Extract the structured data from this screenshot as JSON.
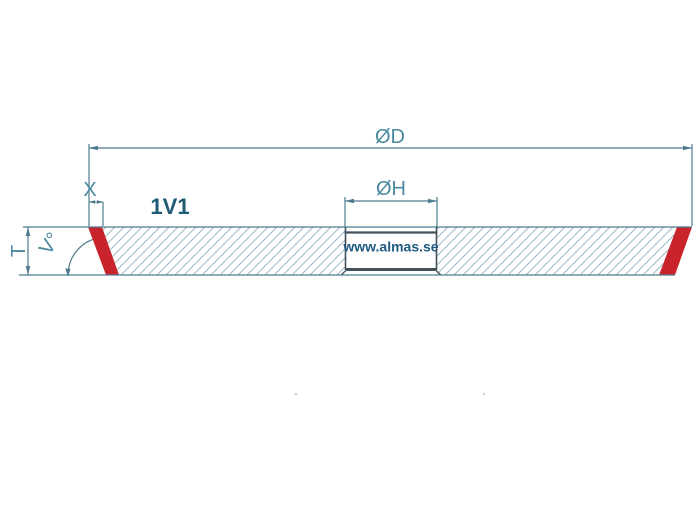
{
  "drawing": {
    "type_label": "1V1",
    "watermark": "www.almas.se",
    "dimensions": {
      "diameter": "ØD",
      "hole_diameter": "ØH",
      "edge_width": "X",
      "thickness": "T",
      "angle": "V°"
    },
    "colors": {
      "background": "#ffffff",
      "line": "#4d7b8d",
      "hatch": "#9db9c5",
      "hole_line": "#42515b",
      "dim_label_text": "#4a8aa0",
      "type_label_text": "#1d5a73",
      "watermark_text": "#1e5a80",
      "bevel_red": "#c9242b"
    }
  }
}
